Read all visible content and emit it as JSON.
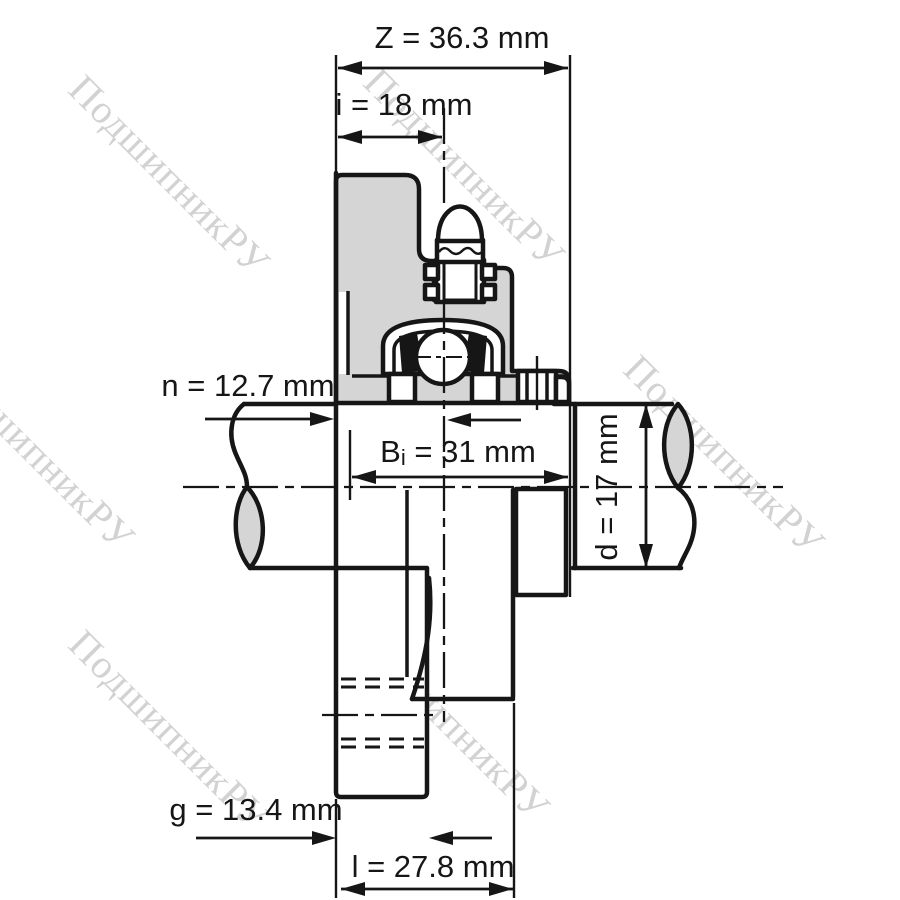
{
  "page": {
    "background": "#ffffff"
  },
  "watermark": {
    "text": "ПодшипникРУ",
    "color": "#c7c7c7"
  },
  "drawing": {
    "type": "flanged-bearing-unit-cross-section",
    "line_color": "#161616",
    "housing_fill": "#d5d5d5",
    "dimensions": {
      "Z": "Z = 36.3 mm",
      "i": "i = 18 mm",
      "n": "n = 12.7 mm",
      "Bi_prefix": "B",
      "Bi_sub": "i",
      "Bi_rest": " = 31 mm",
      "d": "d = 17 mm",
      "g": "g = 13.4 mm",
      "l": "l = 27.8 mm"
    }
  }
}
